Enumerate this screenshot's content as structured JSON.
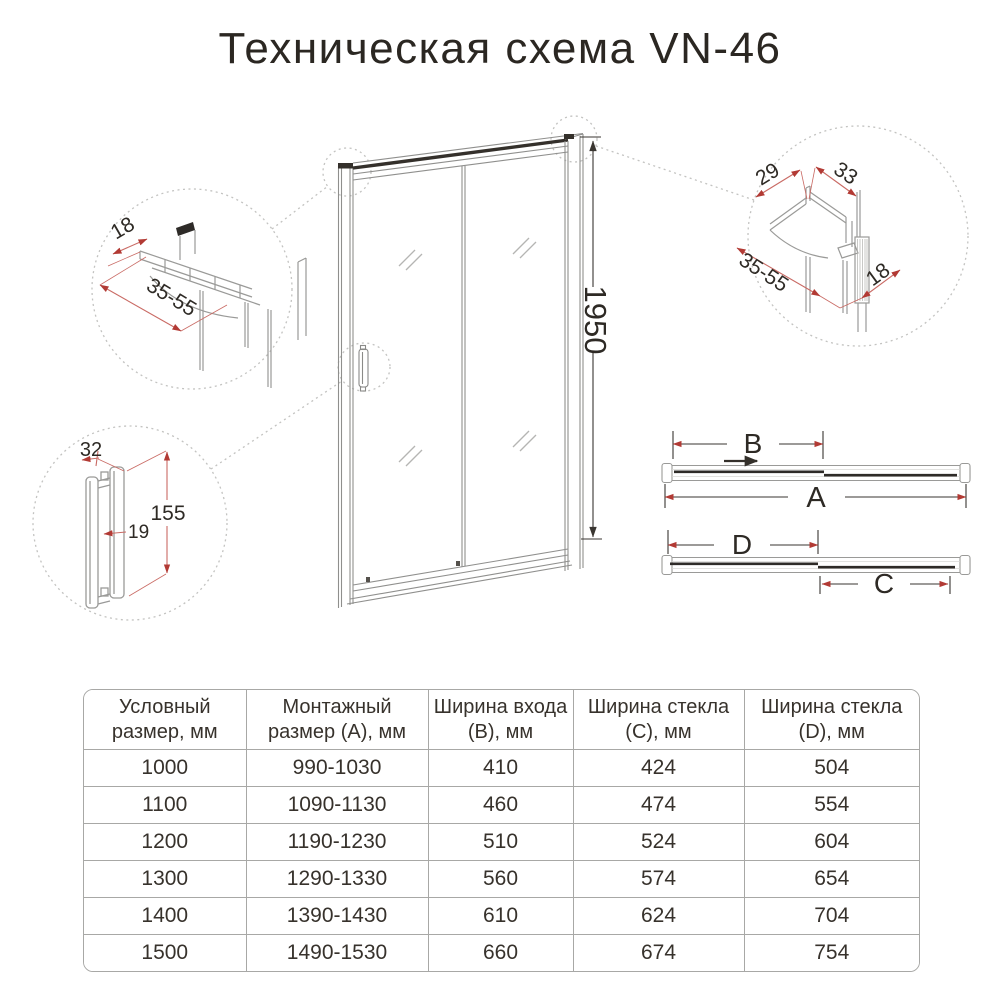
{
  "title": "Техническая схема VN-46",
  "diagram": {
    "door_height_dim": "1950",
    "top_view": {
      "a": "A",
      "b": "B",
      "c": "C",
      "d": "D"
    },
    "callout_top_rail": {
      "depth": "18",
      "adjust_range": "35-55"
    },
    "callout_wall_profile": {
      "w29": "29",
      "w33": "33",
      "adjust_range": "35-55",
      "depth": "18"
    },
    "callout_handle": {
      "width": "32",
      "height": "155",
      "gap": "19"
    }
  },
  "colors": {
    "ink": "#37322c",
    "drawing_gray": "#9a9a98",
    "dotted_gray": "#c3c3c1",
    "dim_red_line": "#c96a64",
    "dim_red_arrow": "#b23a34",
    "table_border": "#a8a8a6"
  },
  "table": {
    "headers": [
      "Условный размер, мм",
      "Монтажный размер (А), мм",
      "Ширина входа (B), мм",
      "Ширина стекла (C), мм",
      "Ширина стекла (D), мм"
    ],
    "rows": [
      [
        "1000",
        "990-1030",
        "410",
        "424",
        "504"
      ],
      [
        "1100",
        "1090-1130",
        "460",
        "474",
        "554"
      ],
      [
        "1200",
        "1190-1230",
        "510",
        "524",
        "604"
      ],
      [
        "1300",
        "1290-1330",
        "560",
        "574",
        "654"
      ],
      [
        "1400",
        "1390-1430",
        "610",
        "624",
        "704"
      ],
      [
        "1500",
        "1490-1530",
        "660",
        "674",
        "754"
      ]
    ]
  }
}
